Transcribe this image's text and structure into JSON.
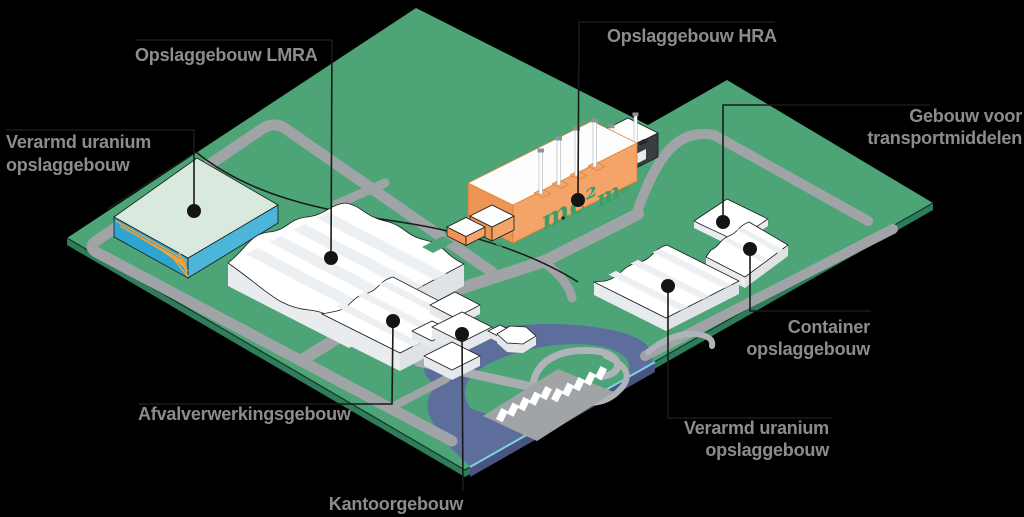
{
  "figure": {
    "kind": "isometric-site-map",
    "description_visible_buildings": 8
  },
  "colors": {
    "background": "#000000",
    "ground": "#4DA477",
    "ground_edge_dark": "#2E7C59",
    "water": "#5D6D9C",
    "water_edge_dark": "#4A5480",
    "water_edge_light": "#7ED3DC",
    "road": "#A0A4A7",
    "path_light": "#AEB4B7",
    "label_text": "#8A8D8F",
    "leader": "#1A1A1A",
    "building_white": "#FFFFFF",
    "building_wall_left": "#E9ECEE",
    "building_wall_right": "#DFE3E5",
    "teal_roof": "#D9E9DE",
    "teal_wall_right": "#4CB5DA",
    "teal_wall_left": "#2EA5D1",
    "accent_orange": "#F4A236",
    "hra_wall_right": "#F4A469",
    "hra_wall_left": "#EE9455",
    "hra_outline": "#D97C2E",
    "hra_text_green": "#3E9E68",
    "bw_wall_dark": "#26282A",
    "bw_wall_side": "#3A3E42"
  },
  "callouts": {
    "vu_left": {
      "line1": "Verarmd uranium",
      "line2": "opslaggebouw"
    },
    "lmra": {
      "line1": "Opslaggebouw LMRA"
    },
    "hra": {
      "line1": "Opslaggebouw HRA"
    },
    "transport": {
      "line1": "Gebouw voor",
      "line2": "transportmiddelen"
    },
    "container": {
      "line1": "Container",
      "line2": "opslaggebouw"
    },
    "vu_right": {
      "line1": "Verarmd uranium",
      "line2": "opslaggebouw"
    },
    "afval": {
      "line1": "Afvalverwerkingsgebouw"
    },
    "kantoor": {
      "line1": "Kantoorgebouw"
    }
  },
  "hra_inscription": {
    "e": "E",
    "equals": "≡",
    "mc2": "mc²",
    "m": "m"
  }
}
